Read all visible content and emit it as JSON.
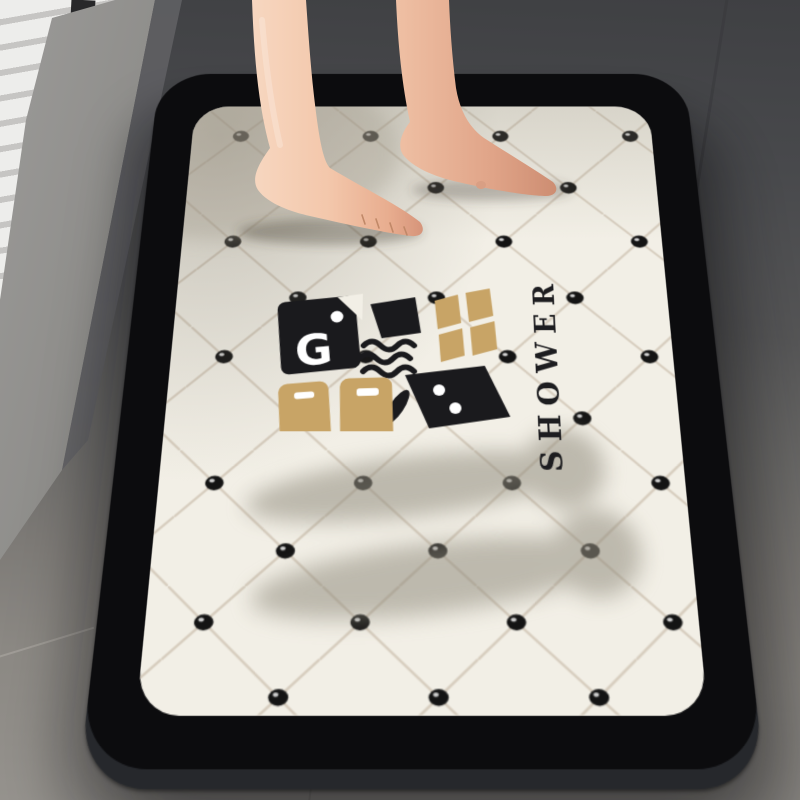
{
  "scene": {
    "description": "Bare feet standing on a black-bordered diatomite bath mat with diamond lattice, grip dots and SHOWER logo, on a grey stone bathroom floor"
  },
  "mat": {
    "shower_text": "SHOWER",
    "emblem_letter": "G"
  },
  "colors": {
    "mat_border": "#0c0c0e",
    "mat_edge": "#26282c",
    "mat_surface": "#f2efe6",
    "lattice_line": "#d6ccbd",
    "dot_black": "#141414",
    "dot_highlight": "#ffffff",
    "logo_black": "#1a1a1d",
    "logo_gold": "#c8a466",
    "shower_text_color": "#1d1d20",
    "floor_dark": "#414245",
    "floor_light": "#96938e",
    "ledge_grey": "#8f8e8b",
    "wall_white": "#ededeb",
    "skin_light": "#f7d7c0",
    "skin_shadow": "#d6947a",
    "shadow_grey": "#928d7f"
  }
}
